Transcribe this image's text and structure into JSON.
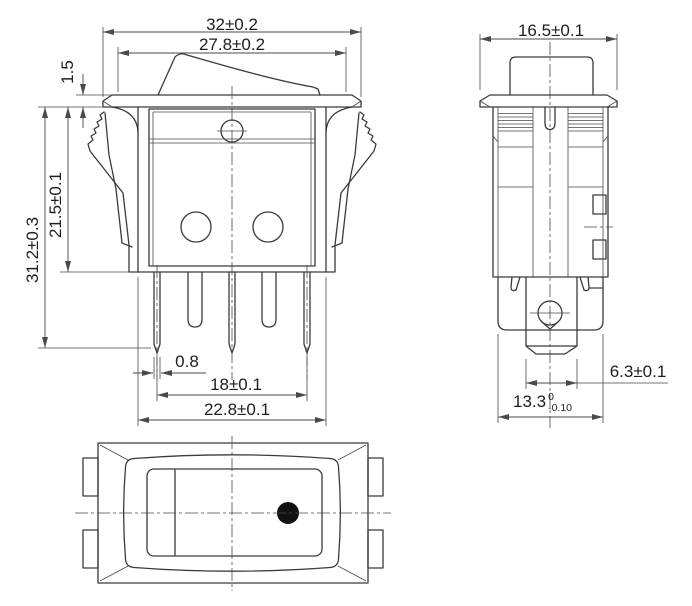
{
  "drawing": {
    "type": "technical-orthographic-drawing",
    "subject": "rocker switch",
    "colors": {
      "line": "#3b3b3b",
      "dim_line": "#4a4a4a",
      "text": "#1e1e1e",
      "background": "#ffffff",
      "indicator_dot": "#111111"
    },
    "front_view": {
      "dim_overall_width": "32±0.2",
      "dim_bezel_width": "27.8±0.2",
      "dim_flange_thickness": "1.5",
      "dim_body_height": "21.5±0.1",
      "dim_overall_height": "31.2±0.3",
      "dim_pin_thickness": "0.8",
      "dim_pin_span": "18±0.1",
      "dim_body_width": "22.8±0.1"
    },
    "side_view": {
      "dim_width": "16.5±0.1",
      "dim_terminal_width": "6.3±0.1",
      "dim_body_width": {
        "value": "13.3",
        "tol_upper": "0",
        "tol_lower": "-0.10"
      }
    }
  }
}
